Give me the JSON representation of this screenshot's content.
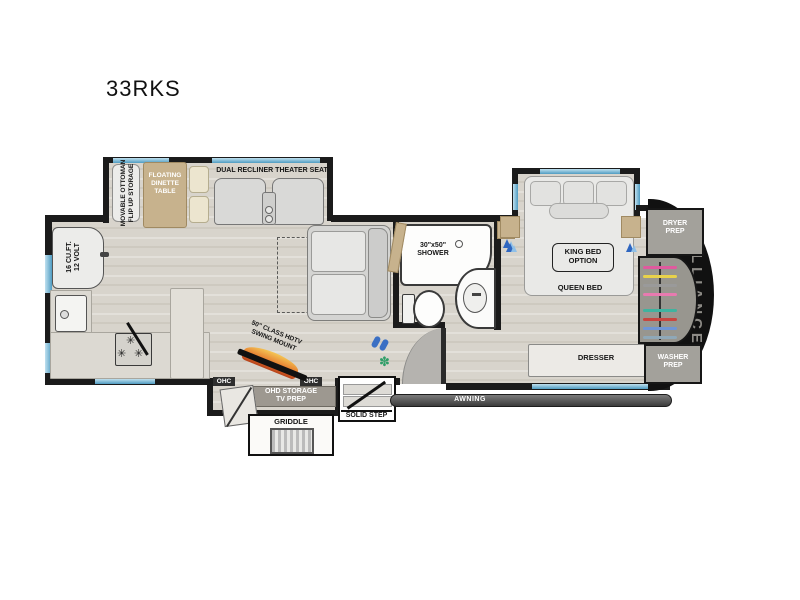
{
  "title": "33RKS",
  "brand": "ALLIANCE",
  "labels": {
    "ottoman": "MOVABLE OTTOMAN\nFLIP UP STORAGE",
    "dinette": "FLOATING\nDINETTE\nTABLE",
    "theater": "DUAL RECLINER THEATER SEAT",
    "fridge": "16 CU.FT.\n12 VOLT",
    "shower": "30\"x50\"\nSHOWER",
    "king_bed": "KING BED\nOPTION",
    "queen_bed": "QUEEN BED",
    "dresser": "DRESSER",
    "dryer": "DRYER\nPREP",
    "washer": "WASHER\nPREP",
    "awning": "AWNING",
    "tv": "50\" CLASS HDTV\nSWING MOUNT",
    "ohc_left": "OHC",
    "ohc_right": "OHC",
    "ohd": "OHD STORAGE\nTV PREP",
    "griddle": "GRIDDLE",
    "step": "SOLID STEP"
  },
  "colors": {
    "wall": "#1b1b1b",
    "floor": "#d8d4cc",
    "window_blue": "#5fa8cc",
    "tan": "#c7b28d",
    "flame_orange": "#e2641e",
    "plant_green": "#2f9e68",
    "icon_blue": "#2f66c0",
    "cap_black": "#111111",
    "cap_text": "#8d8b86",
    "hangers": [
      "#e05a9e",
      "#e8d24a",
      "#9a9a9a",
      "#e87ab0",
      "#3fb39f",
      "#c9453f",
      "#6f95d6",
      "#8fa8b8"
    ]
  }
}
